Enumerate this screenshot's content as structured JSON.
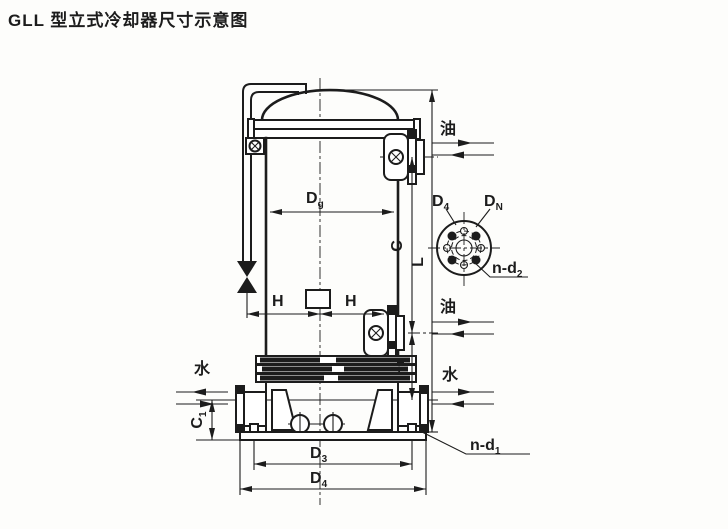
{
  "title": "GLL 型立式冷却器尺寸示意图",
  "colors": {
    "ink": "#1c1c1c",
    "paper": "#fdfdfb"
  },
  "labels": {
    "dg": {
      "main": "D",
      "sub": "g"
    },
    "h_left": "H",
    "h_right": "H",
    "c": "C",
    "l": "L",
    "l1": {
      "main": "L",
      "sub": "1"
    },
    "c1": {
      "main": "C",
      "sub": "1"
    },
    "d3": {
      "main": "D",
      "sub": "3"
    },
    "d4_base": {
      "main": "D",
      "sub": "4"
    },
    "n_d1": {
      "main": "n-d",
      "sub": "1"
    }
  },
  "flange_detail": {
    "d4": {
      "main": "D",
      "sub": "4"
    },
    "dn": {
      "main": "D",
      "sub": "N"
    },
    "n_d2": {
      "main": "n-d",
      "sub": "2"
    }
  },
  "flow": {
    "oil_top": "油",
    "oil_mid": "油",
    "water_right": "水",
    "water_left": "水"
  }
}
